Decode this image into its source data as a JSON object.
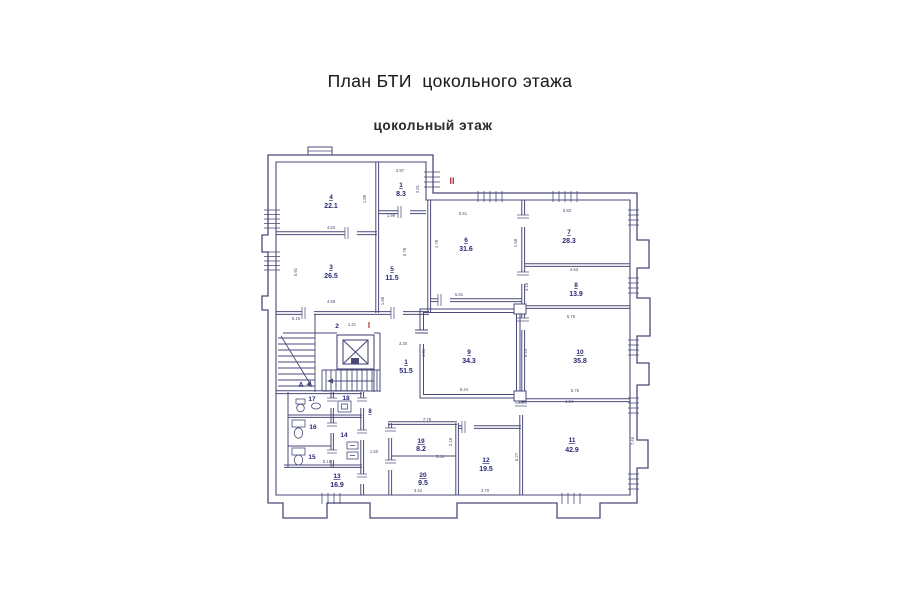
{
  "page": {
    "title": "План БТИ  цокольного этажа",
    "subtitle": "цокольный этаж"
  },
  "colors": {
    "wall_line": "#3d3d70",
    "room_label": "#15156b",
    "section_label_red": "#a32020",
    "dimension_text": "#3c3c68"
  },
  "plan": {
    "labels": {
      "section_upper": "II",
      "section_main": "I",
      "stair": "А",
      "small": "8"
    },
    "rooms": [
      {
        "number": "1",
        "area": "8.3"
      },
      {
        "number": "2",
        "area": ""
      },
      {
        "number": "3",
        "area": "26.5"
      },
      {
        "number": "4",
        "area": "22.1"
      },
      {
        "number": "5",
        "area": "11.5"
      },
      {
        "number": "6",
        "area": "31.6"
      },
      {
        "number": "7",
        "area": "28.3"
      },
      {
        "number": "8",
        "area": "13.9"
      },
      {
        "number": "9",
        "area": "34.3"
      },
      {
        "number": "10",
        "area": "35.8"
      },
      {
        "number": "11",
        "area": "42.9"
      },
      {
        "number": "12",
        "area": "19.5"
      },
      {
        "number": "13",
        "area": "16.9"
      },
      {
        "number": "14",
        "area": ""
      },
      {
        "number": "15",
        "area": ""
      },
      {
        "number": "16",
        "area": ""
      },
      {
        "number": "17",
        "area": ""
      },
      {
        "number": "18",
        "area": ""
      },
      {
        "number": "19",
        "area": "8.2"
      },
      {
        "number": "20",
        "area": "9.5"
      },
      {
        "number": "1",
        "area": "51.5"
      }
    ],
    "dimensions": [
      {
        "t": "2.97"
      },
      {
        "t": "2.81"
      },
      {
        "t": "4.84"
      },
      {
        "t": "1.88"
      },
      {
        "t": "1.99"
      },
      {
        "t": "5.78"
      },
      {
        "t": "1.78"
      },
      {
        "t": "5.51"
      },
      {
        "t": "5.81"
      },
      {
        "t": "1.58"
      },
      {
        "t": "5.83"
      },
      {
        "t": "4.63"
      },
      {
        "t": "3.18"
      },
      {
        "t": "5.76"
      },
      {
        "t": "6.23"
      },
      {
        "t": "5.75"
      },
      {
        "t": "5.91"
      },
      {
        "t": "4.58"
      },
      {
        "t": "5.16"
      },
      {
        "t": "1.21"
      },
      {
        "t": "3.30"
      },
      {
        "t": "4.31"
      },
      {
        "t": "5.44"
      },
      {
        "t": "1.88"
      },
      {
        "t": "7.76"
      },
      {
        "t": "1.50"
      },
      {
        "t": "3.44"
      },
      {
        "t": "3.42"
      },
      {
        "t": "3.70"
      },
      {
        "t": "5.27"
      },
      {
        "t": "4.34"
      },
      {
        "t": "7.46"
      },
      {
        "t": "2.18"
      },
      {
        "t": "5.16"
      }
    ]
  }
}
